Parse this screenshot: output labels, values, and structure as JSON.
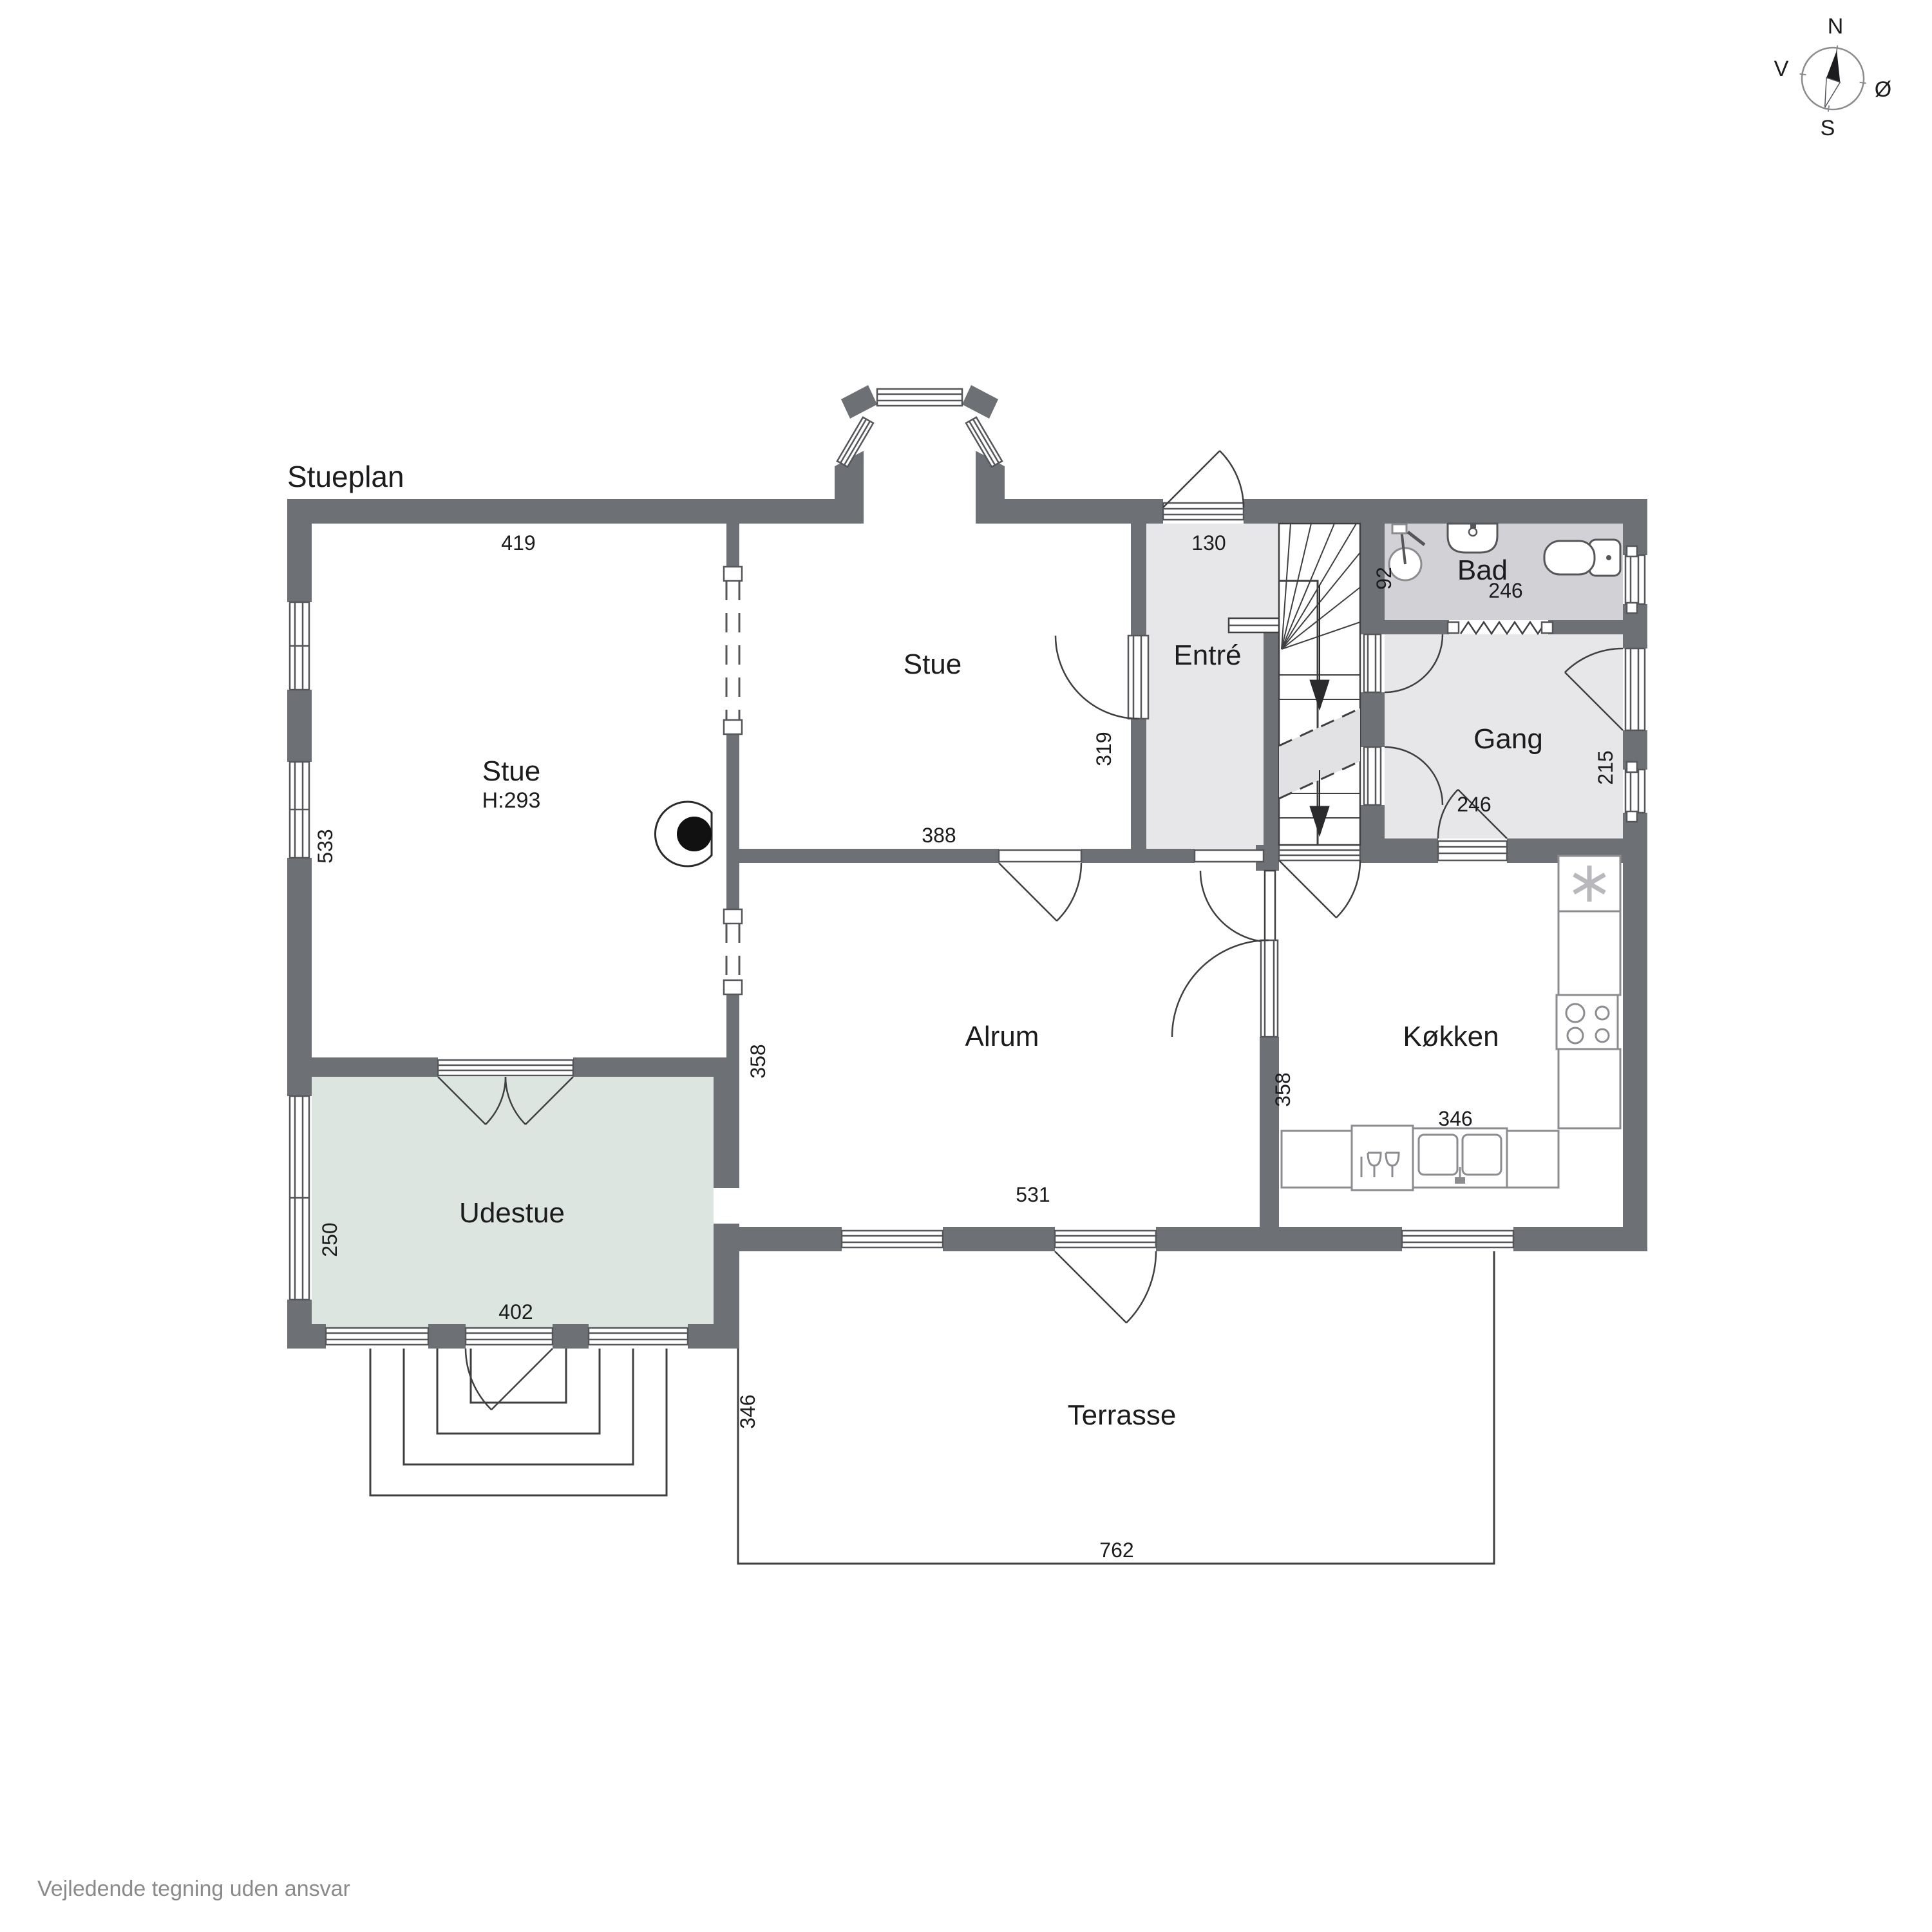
{
  "title": "Stueplan",
  "footer": "Vejledende tegning uden ansvar",
  "compass": {
    "north": "N",
    "south": "S",
    "east": "Ø",
    "west": "V"
  },
  "rooms": {
    "stue_left": {
      "label": "Stue",
      "height_note": "H:293"
    },
    "stue_mid": {
      "label": "Stue"
    },
    "entre": {
      "label": "Entré"
    },
    "bad": {
      "label": "Bad"
    },
    "gang": {
      "label": "Gang"
    },
    "alrum": {
      "label": "Alrum"
    },
    "kokken": {
      "label": "Køkken"
    },
    "udestue": {
      "label": "Udestue"
    },
    "terrasse": {
      "label": "Terrasse"
    }
  },
  "dimensions": {
    "stue_left_width": "419",
    "stue_left_depth": "533",
    "entre_width": "130",
    "bad_depth": "92",
    "bad_width": "246",
    "gang_depth": "215",
    "gang_width": "246",
    "stue_mid_depth": "319",
    "stue_mid_width": "388",
    "alrum_depth": "358",
    "alrum_width": "531",
    "kokken_depth": "358",
    "kokken_width": "346",
    "udestue_depth": "250",
    "udestue_width": "402",
    "terrasse_depth": "346",
    "terrasse_width": "762"
  },
  "colors": {
    "wall": "#6d7074",
    "room_gray_light": "#e7e7e9",
    "room_gray_dark": "#d2d2d6",
    "udestue_green": "#dce5e0",
    "stair_cut_band": "#e2e2e4",
    "footer_text": "#8a8a8a"
  }
}
